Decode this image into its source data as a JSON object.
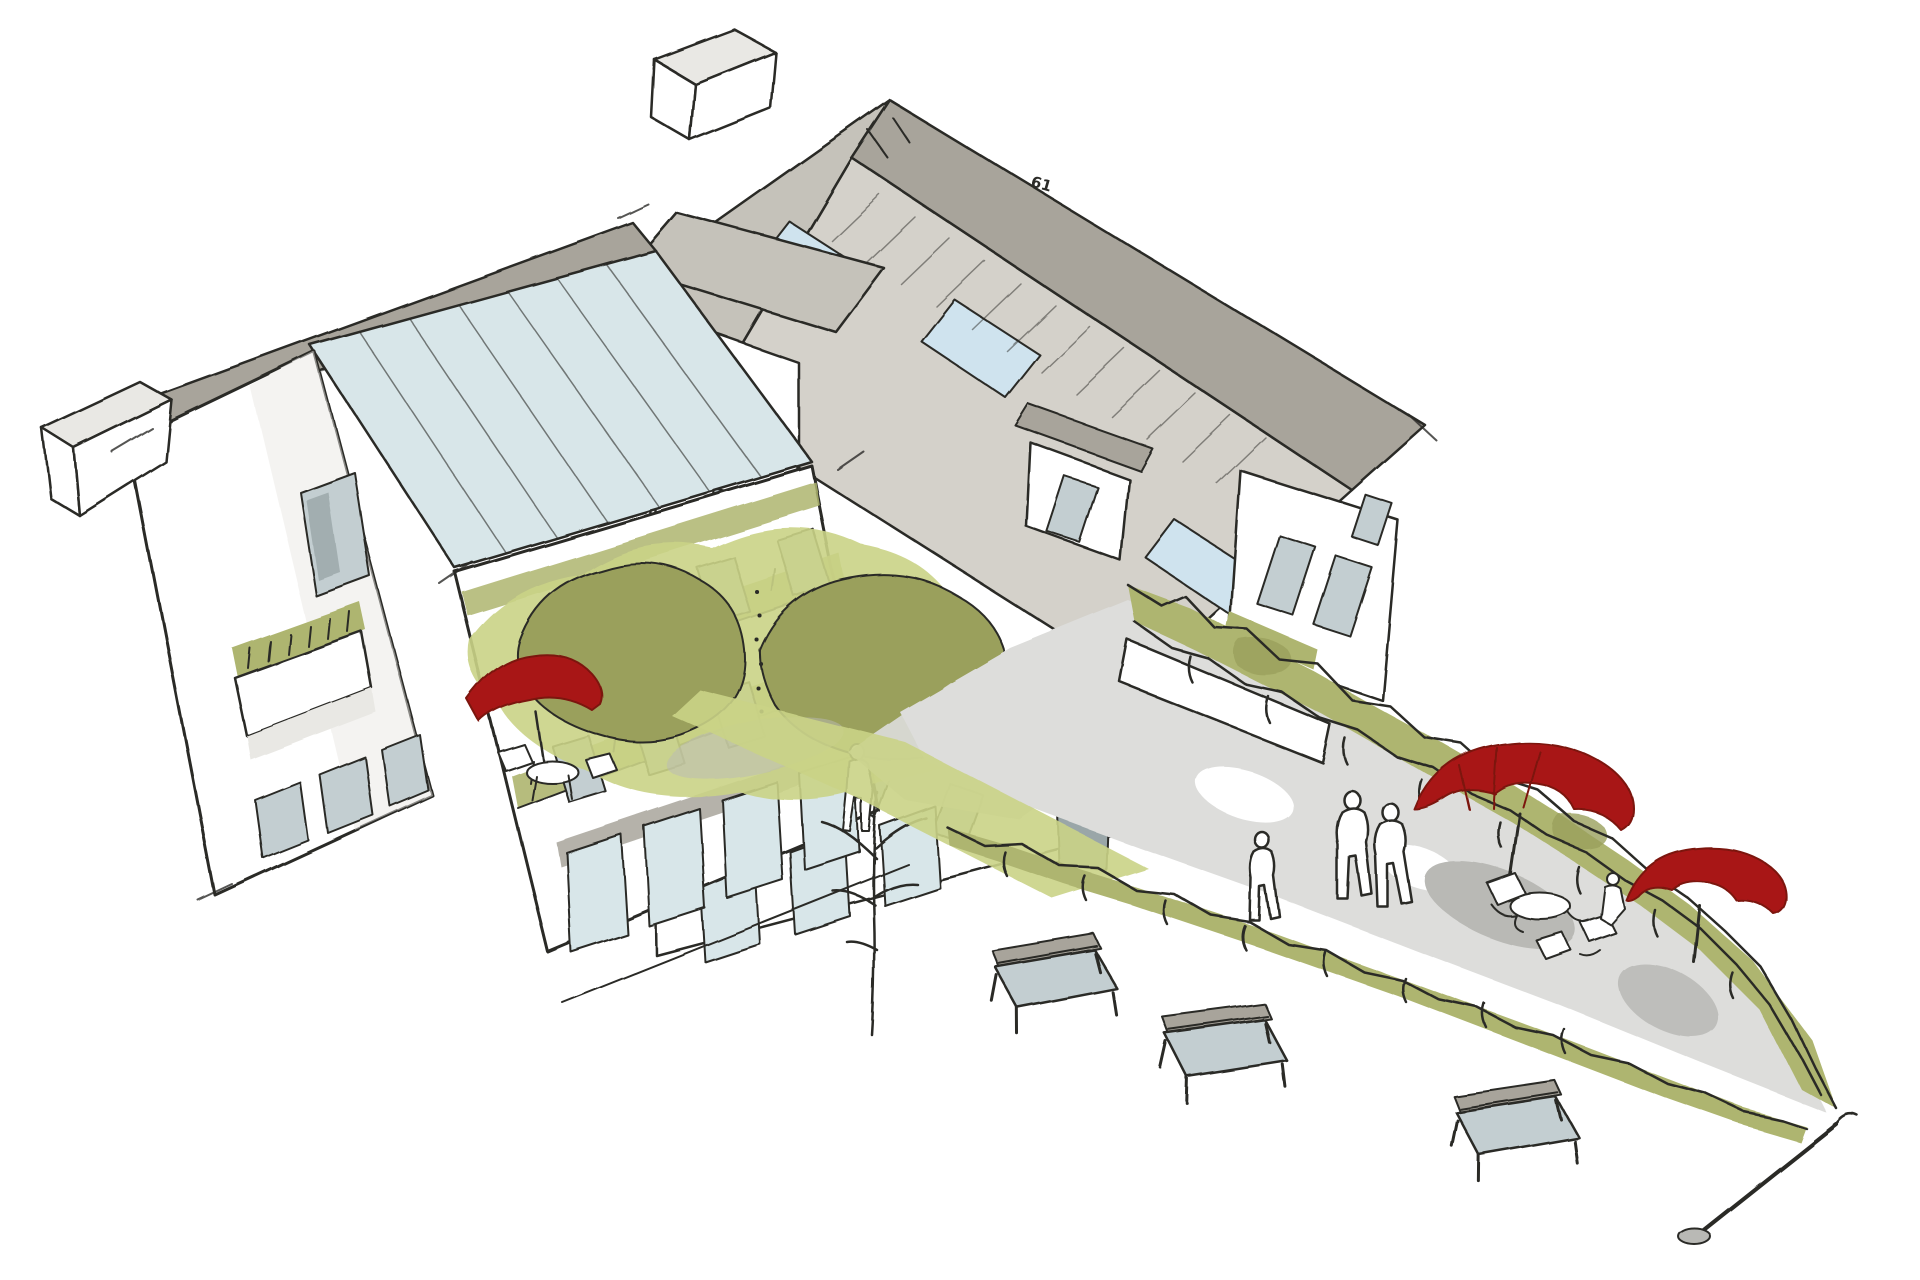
{
  "annotations": {
    "roof_mark": "61"
  },
  "colors": {
    "paper": "#ffffff",
    "ink": "#2b2b28",
    "wall": "#ffffff",
    "wall_shade": "#e9e8e4",
    "roof": "#d4d1ca",
    "roof_dark": "#a8a49b",
    "roof_shade": "#c5c2ba",
    "glass": "#d8e6e9",
    "skylight": "#cfe3ee",
    "window": "#c3ced1",
    "window_dark": "#9aa6a8",
    "veg_dark": "#9aa05c",
    "veg_mid": "#aeb56f",
    "veg_light": "#cad386",
    "lawn": "#cfd98c",
    "red": "#a81717",
    "red_dark": "#7c1210",
    "paving": "#dddddb",
    "paving_dark": "#b9b9b5"
  },
  "scene": {
    "objects": [
      "courtyard-building-with-hipped-roofs",
      "glazed-roof-wing",
      "balconies-with-planting",
      "courtyard-garden-with-trees",
      "red-parasols",
      "plaza-with-hedge-borders",
      "park-benches",
      "pedestrian-figures"
    ],
    "counts": {
      "red_parasols": 3,
      "benches": 3,
      "skylights": 3,
      "figures": 5
    }
  }
}
